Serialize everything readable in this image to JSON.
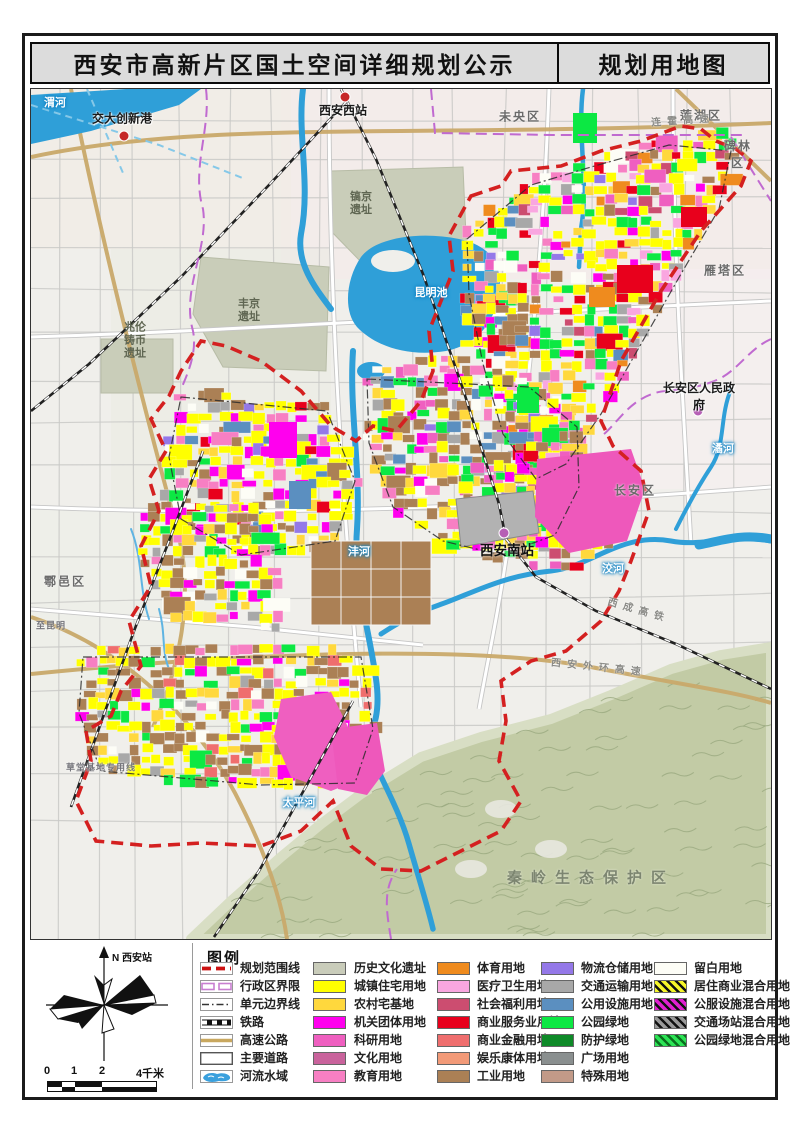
{
  "header": {
    "title_left": "西安市高新片区国土空间详细规划公示",
    "title_right": "规划用地图"
  },
  "compass": {
    "north_label": "N 西安站",
    "scale_labels": [
      "0",
      "1",
      "2",
      "4千米"
    ]
  },
  "legend": {
    "title": "图例",
    "line_items": [
      {
        "symbol": "planning-boundary",
        "label": "规划范围线",
        "color": "#cc1111"
      },
      {
        "symbol": "admin-boundary",
        "label": "行政区界限",
        "color": "#c87fd0"
      },
      {
        "symbol": "unit-boundary",
        "label": "单元边界线",
        "color": "#333333"
      },
      {
        "symbol": "railway",
        "label": "铁路",
        "color": "#111111"
      },
      {
        "symbol": "expressway",
        "label": "高速公路",
        "color": "#c9a85f"
      },
      {
        "symbol": "main-road",
        "label": "主要道路",
        "color": "#555555"
      },
      {
        "symbol": "water",
        "label": "河流水域",
        "color": "#3aa0dd"
      }
    ],
    "landuse_columns": [
      [
        {
          "label": "历史文化遗址",
          "color": "#c9ccba"
        },
        {
          "label": "城镇住宅用地",
          "color": "#ffff00"
        },
        {
          "label": "农村宅基地",
          "color": "#ffd83d"
        },
        {
          "label": "机关团体用地",
          "color": "#ff00ee"
        },
        {
          "label": "科研用地",
          "color": "#ef5fc0"
        },
        {
          "label": "文化用地",
          "color": "#c9639c"
        },
        {
          "label": "教育用地",
          "color": "#f77fc3"
        }
      ],
      [
        {
          "label": "体育用地",
          "color": "#ef8b1e"
        },
        {
          "label": "医疗卫生用地",
          "color": "#f9a6e0"
        },
        {
          "label": "社会福利用地",
          "color": "#cc4d70"
        },
        {
          "label": "商业服务业用地",
          "color": "#e8001c"
        },
        {
          "label": "商业金融用地",
          "color": "#ef6e6e"
        },
        {
          "label": "娱乐康体用地",
          "color": "#f29a78"
        },
        {
          "label": "工业用地",
          "color": "#ab8055"
        }
      ],
      [
        {
          "label": "物流仓储用地",
          "color": "#9478e8"
        },
        {
          "label": "交通运输用地",
          "color": "#a8a8a8"
        },
        {
          "label": "公用设施用地",
          "color": "#5b8fc0"
        },
        {
          "label": "公园绿地",
          "color": "#0ce843"
        },
        {
          "label": "防护绿地",
          "color": "#0e8a28"
        },
        {
          "label": "广场用地",
          "color": "#8a8f8f"
        },
        {
          "label": "特殊用地",
          "color": "#c29a88"
        }
      ],
      [
        {
          "label": "留白用地",
          "color": "#fdfdf6"
        },
        {
          "label": "居住商业混合用地",
          "color": "#f5f52a",
          "hatch": "#111111"
        },
        {
          "label": "公服设施混合用地",
          "color": "#e020d0",
          "hatch": "#111111"
        },
        {
          "label": "交通场站混合用地",
          "color": "#9a9a9a",
          "hatch": "#111111"
        },
        {
          "label": "公园绿地混合用地",
          "color": "#2ce455",
          "hatch": "#0a6e1e"
        }
      ]
    ]
  },
  "map": {
    "labels": [
      {
        "text": "渭河",
        "kind": "river",
        "x": 24,
        "y": 13
      },
      {
        "text": "昆明池",
        "kind": "river",
        "x": 400,
        "y": 203
      },
      {
        "text": "沣河",
        "kind": "river",
        "x": 328,
        "y": 462
      },
      {
        "text": "洨河",
        "kind": "river",
        "x": 582,
        "y": 479
      },
      {
        "text": "潏河",
        "kind": "river",
        "x": 692,
        "y": 359
      },
      {
        "text": "太平河",
        "kind": "river",
        "x": 268,
        "y": 713
      },
      {
        "text": "未央区",
        "kind": "district",
        "x": 489,
        "y": 27
      },
      {
        "text": "莲湖区",
        "kind": "district",
        "x": 670,
        "y": 26
      },
      {
        "text": "碑林区",
        "kind": "district",
        "x": 707,
        "y": 65
      },
      {
        "text": "雁塔区",
        "kind": "district",
        "x": 694,
        "y": 181
      },
      {
        "text": "长安区",
        "kind": "district",
        "x": 604,
        "y": 401
      },
      {
        "text": "鄠邑区",
        "kind": "district",
        "x": 34,
        "y": 492
      },
      {
        "text": "交大创新港",
        "kind": "poi",
        "x": 91,
        "y": 29,
        "dot": [
          93,
          47
        ],
        "dotc": "#c62828"
      },
      {
        "text": "西安西站",
        "kind": "poi",
        "x": 312,
        "y": 21,
        "dot": [
          314,
          8
        ],
        "dotc": "#c62828"
      },
      {
        "text": "西安南站",
        "kind": "poi-big",
        "x": 476,
        "y": 460,
        "dot": [
          473,
          444
        ],
        "dotc": "#b65fb5"
      },
      {
        "text": "长安区人民政府",
        "kind": "poi",
        "x": 668,
        "y": 307,
        "dot": [
          667,
          322
        ],
        "dotc": "#b65fb5"
      },
      {
        "text": "镐京\n遗址",
        "kind": "site",
        "x": 330,
        "y": 115
      },
      {
        "text": "丰京\n遗址",
        "kind": "site",
        "x": 218,
        "y": 222
      },
      {
        "text": "兆伦\n铸币\n遗址",
        "kind": "site",
        "x": 104,
        "y": 252
      },
      {
        "text": "连霍高速",
        "kind": "road",
        "x": 652,
        "y": 30,
        "rot": -4
      },
      {
        "text": "西成高铁",
        "kind": "road",
        "x": 608,
        "y": 520,
        "rot": 16
      },
      {
        "text": "西安外环高速",
        "kind": "road",
        "x": 568,
        "y": 577,
        "rot": 6
      },
      {
        "text": "至昆明",
        "kind": "road-sm",
        "x": 20,
        "y": 536,
        "rot": 0
      },
      {
        "text": "草堂基地专用线",
        "kind": "road-sm",
        "x": 70,
        "y": 678,
        "rot": 0
      },
      {
        "text": "秦岭生态保护区",
        "kind": "area",
        "x": 560,
        "y": 788
      }
    ]
  }
}
